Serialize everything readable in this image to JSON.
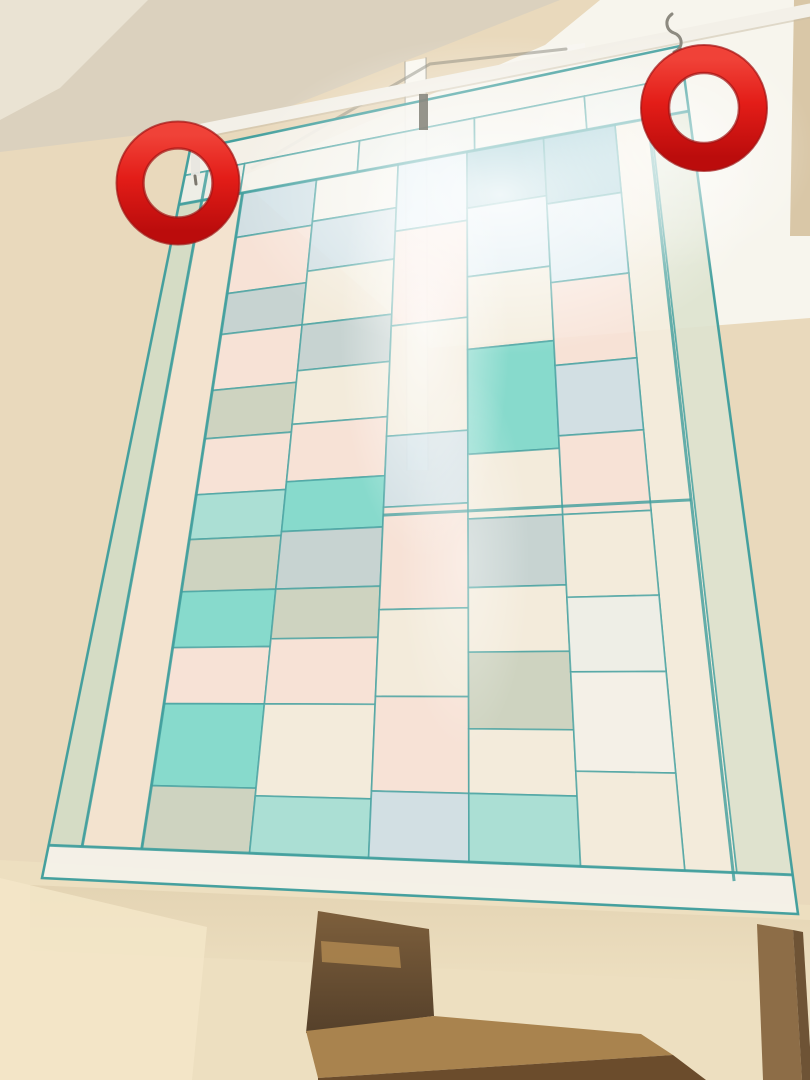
{
  "photo": {
    "width": 810,
    "height": 1080
  },
  "palette": {
    "wall_base": "#e9d9bc",
    "wall_lower": "#eddfc0",
    "ceiling_main": "#dbd1be",
    "ceiling_corner": "#eae3d3",
    "window_light": "#f7f5ed",
    "rod_white": "#f3f0e8",
    "rod_shadow": "#c9bda5",
    "annotation_red_top": "#f04238",
    "annotation_red_bottom": "#bb0c0c",
    "stair_tread": "#a9834e",
    "stair_dark": "#6b4c2c"
  },
  "background": {
    "shapes": [
      {
        "name": "wall-base",
        "pts": [
          [
            0,
            0
          ],
          [
            810,
            0
          ],
          [
            810,
            1080
          ],
          [
            0,
            1080
          ]
        ],
        "fill": "#e9d9bc"
      },
      {
        "name": "wall-lower",
        "pts": [
          [
            0,
            860
          ],
          [
            810,
            905
          ],
          [
            810,
            1080
          ],
          [
            0,
            1080
          ]
        ],
        "fill": "#eddfc0"
      },
      {
        "name": "ceiling-main",
        "pts": [
          [
            0,
            0
          ],
          [
            560,
            0
          ],
          [
            253,
            121
          ],
          [
            0,
            152
          ]
        ],
        "fill": "#dbd1be"
      },
      {
        "name": "ceiling-corner",
        "pts": [
          [
            0,
            0
          ],
          [
            148,
            0
          ],
          [
            60,
            88
          ],
          [
            0,
            120
          ]
        ],
        "fill": "#eae3d3"
      },
      {
        "name": "window-light",
        "pts": [
          [
            238,
            178
          ],
          [
            545,
            45
          ],
          [
            600,
            0
          ],
          [
            810,
            0
          ],
          [
            810,
            318
          ],
          [
            430,
            348
          ]
        ],
        "fill": "#f7f5ed"
      },
      {
        "name": "window-frame-mullion",
        "pts": [
          [
            405,
            62
          ],
          [
            426,
            58
          ],
          [
            428,
            470
          ],
          [
            407,
            470
          ]
        ],
        "fill": "#fbfaf6",
        "opacity": 0.88
      },
      {
        "name": "window-frame-right-bar",
        "pts": [
          [
            567,
            45
          ],
          [
            585,
            43
          ],
          [
            586,
            262
          ],
          [
            568,
            264
          ]
        ],
        "fill": "#f8f7f2",
        "opacity": 0.7
      },
      {
        "name": "wall-strip-top-right",
        "pts": [
          [
            794,
            0
          ],
          [
            810,
            0
          ],
          [
            810,
            236
          ],
          [
            790,
            236
          ]
        ],
        "fill": "#d9c7a7"
      }
    ],
    "lines": [
      {
        "name": "window-frame-top-line",
        "pts": [
          [
            252,
            168
          ],
          [
            430,
            64
          ],
          [
            566,
            49
          ]
        ],
        "stroke": "#6f6f64",
        "width": 3,
        "opacity": 0.45
      },
      {
        "name": "window-frame-mullion-edge-left",
        "pts": [
          [
            405,
            62
          ],
          [
            407,
            470
          ]
        ],
        "stroke": "#8f8f85",
        "width": 1.5,
        "opacity": 0.5
      },
      {
        "name": "window-frame-mullion-edge-right",
        "pts": [
          [
            426,
            58
          ],
          [
            428,
            470
          ]
        ],
        "stroke": "#8f8f85",
        "width": 1.5,
        "opacity": 0.5
      }
    ]
  },
  "rod": {
    "line": [
      152,
      140,
      810,
      10
    ],
    "width": 13,
    "color": "#f3f0e8",
    "shadow_line": [
      152,
      147,
      810,
      17
    ],
    "shadow_width": 3,
    "shadow_color": "#c9bda5",
    "shadow_opacity": 0.5
  },
  "curtain": {
    "quad": [
      [
        190,
        150
      ],
      [
        680,
        46
      ],
      [
        798,
        914
      ],
      [
        42,
        878
      ]
    ],
    "seam_color": "#4aa3a2",
    "seam_width": 1.7,
    "seam_opacity": 0.78,
    "outline_color": "#3f9d9c",
    "outline_width": 2.6,
    "fabric_palette": {
      "PE": "#f7e3d8",
      "PE2": "#f3e4d0",
      "CR": "#f3eddd",
      "WH": "#f4f2ea",
      "WH2": "#eef0e9",
      "BL": "#cfe0e6",
      "SKY": "#dcecf2",
      "TB": "#8fc4cf",
      "BG": "#c3d2d3",
      "GG": "#cbd2c0",
      "AQ": "#7edacd",
      "AQ2": "#a5dfd6",
      "LG": "#d2dcc6",
      "LG2": "#dde3cf"
    },
    "patches": [
      [
        "WH",
        0,
        0,
        1,
        0.035
      ],
      [
        "WH2",
        0,
        0.035,
        0.12,
        0.04
      ],
      [
        "WH",
        0.12,
        0.035,
        0.23,
        0.04
      ],
      [
        "WH2",
        0.35,
        0.035,
        0.23,
        0.04
      ],
      [
        "WH",
        0.58,
        0.035,
        0.22,
        0.04
      ],
      [
        "WH2",
        0.8,
        0.035,
        0.2,
        0.04
      ],
      [
        "LG",
        0,
        0.075,
        0.045,
        0.88
      ],
      [
        "PE2",
        0.045,
        0.075,
        0.08,
        0.88
      ],
      [
        "CR",
        0.855,
        0.075,
        0.07,
        0.88
      ],
      [
        "LG2",
        0.925,
        0.075,
        0.075,
        0.88
      ],
      [
        "WH",
        0,
        0.955,
        1,
        0.045
      ],
      [
        "BL",
        0.125,
        0.075,
        0.145,
        0.06
      ],
      [
        "PE",
        0.125,
        0.135,
        0.145,
        0.075
      ],
      [
        "BG",
        0.125,
        0.21,
        0.145,
        0.055
      ],
      [
        "PE",
        0.125,
        0.265,
        0.145,
        0.075
      ],
      [
        "GG",
        0.125,
        0.34,
        0.145,
        0.065
      ],
      [
        "PE",
        0.125,
        0.405,
        0.145,
        0.075
      ],
      [
        "AQ2",
        0.125,
        0.48,
        0.145,
        0.06
      ],
      [
        "GG",
        0.125,
        0.54,
        0.145,
        0.07
      ],
      [
        "AQ",
        0.125,
        0.61,
        0.145,
        0.075
      ],
      [
        "PE",
        0.125,
        0.685,
        0.145,
        0.075
      ],
      [
        "AQ",
        0.125,
        0.76,
        0.145,
        0.11
      ],
      [
        "GG",
        0.125,
        0.87,
        0.145,
        0.085
      ],
      [
        "WH",
        0.27,
        0.075,
        0.16,
        0.055
      ],
      [
        "BL",
        0.27,
        0.13,
        0.16,
        0.065
      ],
      [
        "CR",
        0.27,
        0.195,
        0.16,
        0.07
      ],
      [
        "BG",
        0.27,
        0.265,
        0.16,
        0.06
      ],
      [
        "CR",
        0.27,
        0.325,
        0.16,
        0.07
      ],
      [
        "PE",
        0.27,
        0.395,
        0.16,
        0.075
      ],
      [
        "AQ",
        0.27,
        0.47,
        0.16,
        0.065
      ],
      [
        "BG",
        0.27,
        0.535,
        0.16,
        0.075
      ],
      [
        "GG",
        0.27,
        0.61,
        0.16,
        0.065
      ],
      [
        "PE",
        0.27,
        0.675,
        0.16,
        0.085
      ],
      [
        "CR",
        0.27,
        0.76,
        0.16,
        0.12
      ],
      [
        "AQ2",
        0.27,
        0.88,
        0.16,
        0.075
      ],
      [
        "SKY",
        0.43,
        0.075,
        0.135,
        0.085
      ],
      [
        "PE",
        0.43,
        0.16,
        0.135,
        0.12
      ],
      [
        "CR",
        0.43,
        0.28,
        0.135,
        0.14
      ],
      [
        "BL",
        0.43,
        0.42,
        0.135,
        0.09
      ],
      [
        "PE",
        0.43,
        0.51,
        0.135,
        0.13
      ],
      [
        "CR",
        0.43,
        0.64,
        0.135,
        0.11
      ],
      [
        "PE",
        0.43,
        0.75,
        0.135,
        0.12
      ],
      [
        "BL",
        0.43,
        0.87,
        0.135,
        0.085
      ],
      [
        "TB",
        0.565,
        0.075,
        0.15,
        0.07
      ],
      [
        "SKY",
        0.565,
        0.145,
        0.15,
        0.085
      ],
      [
        "CR",
        0.565,
        0.23,
        0.15,
        0.09
      ],
      [
        "AQ",
        0.565,
        0.32,
        0.15,
        0.13
      ],
      [
        "CR",
        0.565,
        0.45,
        0.15,
        0.08
      ],
      [
        "BG",
        0.565,
        0.53,
        0.15,
        0.085
      ],
      [
        "CR",
        0.565,
        0.615,
        0.15,
        0.08
      ],
      [
        "GG",
        0.565,
        0.695,
        0.15,
        0.095
      ],
      [
        "CR",
        0.565,
        0.79,
        0.15,
        0.08
      ],
      [
        "AQ2",
        0.565,
        0.87,
        0.15,
        0.085
      ],
      [
        "TB",
        0.715,
        0.075,
        0.14,
        0.08
      ],
      [
        "SKY",
        0.715,
        0.155,
        0.14,
        0.095
      ],
      [
        "PE",
        0.715,
        0.25,
        0.14,
        0.1
      ],
      [
        "BL",
        0.715,
        0.35,
        0.14,
        0.085
      ],
      [
        "PE",
        0.715,
        0.435,
        0.14,
        0.095
      ],
      [
        "CR",
        0.715,
        0.53,
        0.14,
        0.1
      ],
      [
        "WH2",
        0.715,
        0.63,
        0.14,
        0.09
      ],
      [
        "WH",
        0.715,
        0.72,
        0.14,
        0.12
      ],
      [
        "CR",
        0.715,
        0.84,
        0.14,
        0.115
      ]
    ],
    "accent_seams": [
      [
        0,
        0.075,
        1,
        0.075
      ],
      [
        0.125,
        0.075,
        0.125,
        0.955
      ],
      [
        0.92,
        0.075,
        0.92,
        0.965
      ],
      [
        0.43,
        0.52,
        0.92,
        0.52
      ],
      [
        0,
        0.955,
        1,
        0.955
      ],
      [
        0.045,
        0.035,
        0.045,
        0.955
      ]
    ]
  },
  "light_overlays": [
    {
      "name": "window-glow-main",
      "cx": 500,
      "cy": 195,
      "rx": 265,
      "ry": 160,
      "opacity": 0.9
    },
    {
      "name": "window-glow-streak",
      "cx": 425,
      "cy": 330,
      "rx": 85,
      "ry": 230,
      "opacity": 0.7
    },
    {
      "name": "window-glow-lower",
      "cx": 465,
      "cy": 560,
      "rx": 65,
      "ry": 190,
      "opacity": 0.4
    },
    {
      "name": "window-glow-right",
      "cx": 665,
      "cy": 150,
      "rx": 150,
      "ry": 120,
      "opacity": 0.6
    }
  ],
  "hardware": {
    "shapes": [
      {
        "name": "left-curtain-clip",
        "pts": [
          [
            191,
            146
          ],
          [
            200,
            146
          ],
          [
            200,
            176
          ],
          [
            191,
            176
          ]
        ],
        "fill": "#e8e6e0",
        "opacity": 0.95
      },
      {
        "name": "center-curtain-clip",
        "pts": [
          [
            419,
            94
          ],
          [
            428,
            94
          ],
          [
            428,
            130
          ],
          [
            419,
            130
          ]
        ],
        "fill": "#8a887f",
        "opacity": 0.9
      }
    ],
    "lines": [
      {
        "name": "left-clip-hook",
        "pts": [
          [
            195,
            176
          ],
          [
            196,
            184
          ]
        ],
        "stroke": "#6f6a60",
        "width": 3,
        "opacity": 0.9
      }
    ],
    "paths": [
      {
        "name": "right-s-hook",
        "d": "M672,14 C664,20 666,30 674,33 C683,36 684,48 674,52",
        "stroke": "#8d8a80",
        "width": 3
      }
    ]
  },
  "wall_shadow_band": {
    "pts": [
      [
        30,
        885
      ],
      [
        810,
        920
      ],
      [
        810,
        985
      ],
      [
        30,
        950
      ]
    ],
    "opacity": 0.5
  },
  "stairs": {
    "shapes": [
      {
        "name": "stairwell-niche",
        "pts": [
          [
            318,
            911
          ],
          [
            429,
            929
          ],
          [
            434,
            1016
          ],
          [
            306,
            1033
          ]
        ],
        "fill": "url(#nicheGrad)"
      },
      {
        "name": "stair-tread-upper",
        "pts": [
          [
            321,
            941
          ],
          [
            399,
            947
          ],
          [
            401,
            968
          ],
          [
            322,
            962
          ]
        ],
        "fill": "#a8824d",
        "opacity": 0.95
      },
      {
        "name": "stair-tread-lower",
        "pts": [
          [
            306,
            1031
          ],
          [
            434,
            1016
          ],
          [
            641,
            1034
          ],
          [
            673,
            1055
          ],
          [
            318,
            1078
          ]
        ],
        "fill": "#a9834e"
      },
      {
        "name": "stair-riser-lower",
        "pts": [
          [
            318,
            1078
          ],
          [
            673,
            1055
          ],
          [
            706,
            1080
          ],
          [
            318,
            1080
          ]
        ],
        "fill": "#6b4c2c"
      },
      {
        "name": "wall-trim-right",
        "pts": [
          [
            757,
            924
          ],
          [
            793,
            930
          ],
          [
            802,
            1080
          ],
          [
            763,
            1080
          ]
        ],
        "fill": "#8d6d47"
      },
      {
        "name": "wall-trim-right-edge",
        "pts": [
          [
            793,
            930
          ],
          [
            803,
            932
          ],
          [
            812,
            1080
          ],
          [
            802,
            1080
          ]
        ],
        "fill": "#6e5335"
      },
      {
        "name": "wall-corner-left",
        "pts": [
          [
            0,
            878
          ],
          [
            207,
            927
          ],
          [
            192,
            1080
          ],
          [
            0,
            1080
          ]
        ],
        "fill": "#f3e6c8",
        "opacity": 0.85
      }
    ]
  },
  "annotations": {
    "circles": [
      {
        "name": "annotation-circle-left",
        "cx": 178,
        "cy": 183,
        "r": 48,
        "width": 27
      },
      {
        "name": "annotation-circle-right",
        "cx": 704,
        "cy": 108,
        "r": 49,
        "width": 28
      }
    ],
    "edge_color": "#a31212"
  }
}
